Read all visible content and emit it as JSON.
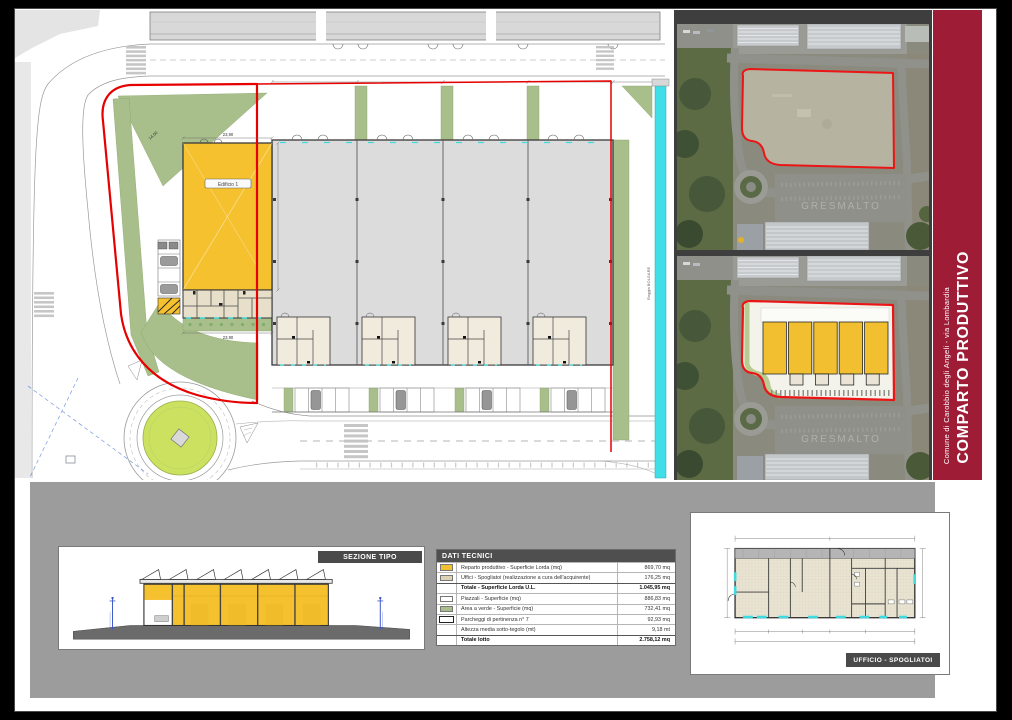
{
  "banner": {
    "title": "COMPARTO PRODUTTIVO",
    "subtitle": "Comune di Carobbio degli Angeli - via Lombardia",
    "bg": "#9E1C36"
  },
  "plan": {
    "building_label": "Edificio 1",
    "canal_label": "Roggia BOLGARE",
    "dims": {
      "top_width": "23,90",
      "bottom_width": "23,90",
      "hyp": "14,00"
    }
  },
  "photos": {
    "ground_text": "GRESMALTO"
  },
  "section_panel": {
    "label": "SEZIONE TIPO"
  },
  "office_panel": {
    "label": "UFFICIO - SPOGLIATOI"
  },
  "dati_tecnici": {
    "header": "DATI TECNICI",
    "rows": [
      {
        "swatch": "#F2C12E",
        "label": "Reparto produttivo - Superficie Lorda (mq)",
        "value": "869,70 mq",
        "bold": false
      },
      {
        "swatch": "#DCD3B4",
        "label": "Uffici - Spogliatoi (realizzazione a cura dell'acquirente)",
        "value": "176,25 mq",
        "bold": false
      },
      {
        "swatch": null,
        "label": "Totale - Superficie Lorda U.L.",
        "value": "1.045,95 mq",
        "bold": true
      },
      {
        "swatch": "#FFFFFF",
        "label": "Piazzali - Superficie (mq)",
        "value": "886,83 mq",
        "bold": false
      },
      {
        "swatch": "#A9BF8B",
        "label": "Area a verde - Superficie (mq)",
        "value": "732,41 mq",
        "bold": false
      },
      {
        "swatch": "parking",
        "label": "Parcheggi di pertinenza n° 7",
        "value": "92,93 mq",
        "bold": false
      },
      {
        "swatch": null,
        "label": "Altezza media sotto-tegolo (mt)",
        "value": "9,18 mt",
        "bold": false
      },
      {
        "swatch": null,
        "label": "Totale lotto",
        "value": "2.758,12 mq",
        "bold": true
      }
    ]
  },
  "colors": {
    "banner_red": "#9E1C36",
    "boundary_red": "#E60000",
    "building_yellow": "#F5C12F",
    "green_area": "#A9BF8B",
    "roundabout_green": "#CBE15F",
    "canal_cyan": "#40DEE8",
    "strip_gray": "#9C9C9C",
    "label_box": "#4A4A4A"
  }
}
